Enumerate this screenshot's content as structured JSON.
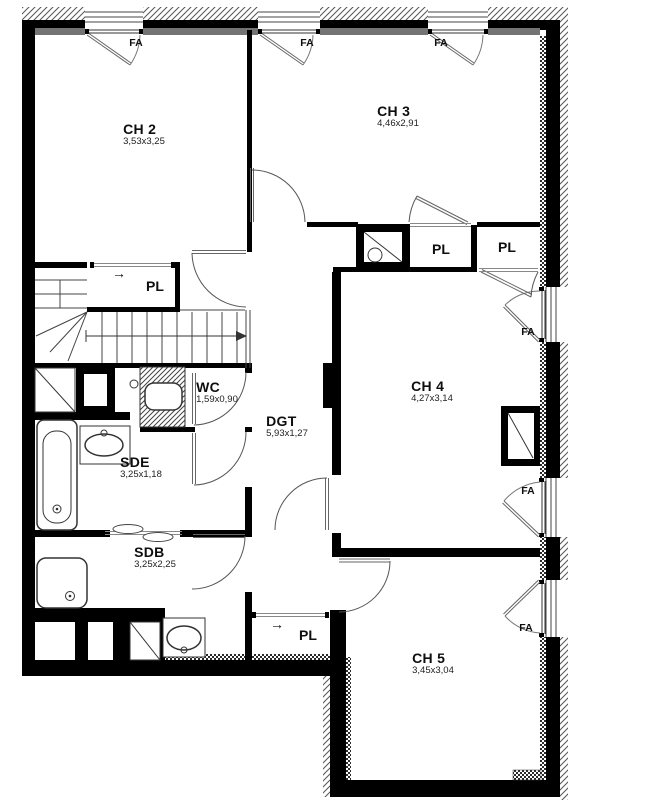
{
  "rooms": [
    {
      "id": "ch2",
      "name": "CH 2",
      "dims": "3,53x3,25"
    },
    {
      "id": "ch3",
      "name": "CH 3",
      "dims": "4,46x2,91"
    },
    {
      "id": "ch4",
      "name": "CH 4",
      "dims": "4,27x3,14"
    },
    {
      "id": "ch5",
      "name": "CH 5",
      "dims": "3,45x3,04"
    },
    {
      "id": "wc",
      "name": "WC",
      "dims": "1,59x0,90"
    },
    {
      "id": "dgt",
      "name": "DGT",
      "dims": "5,93x1,27"
    },
    {
      "id": "sde",
      "name": "SDE",
      "dims": "3,25x1,18"
    },
    {
      "id": "sdb",
      "name": "SDB",
      "dims": "3,25x2,25"
    }
  ],
  "labels": {
    "closet": "PL",
    "window": "FA",
    "slide_arrow": "→"
  },
  "colors": {
    "wall": "#000000",
    "line": "#4a4a4a",
    "text": "#0e0e0e",
    "background": "#ffffff"
  }
}
